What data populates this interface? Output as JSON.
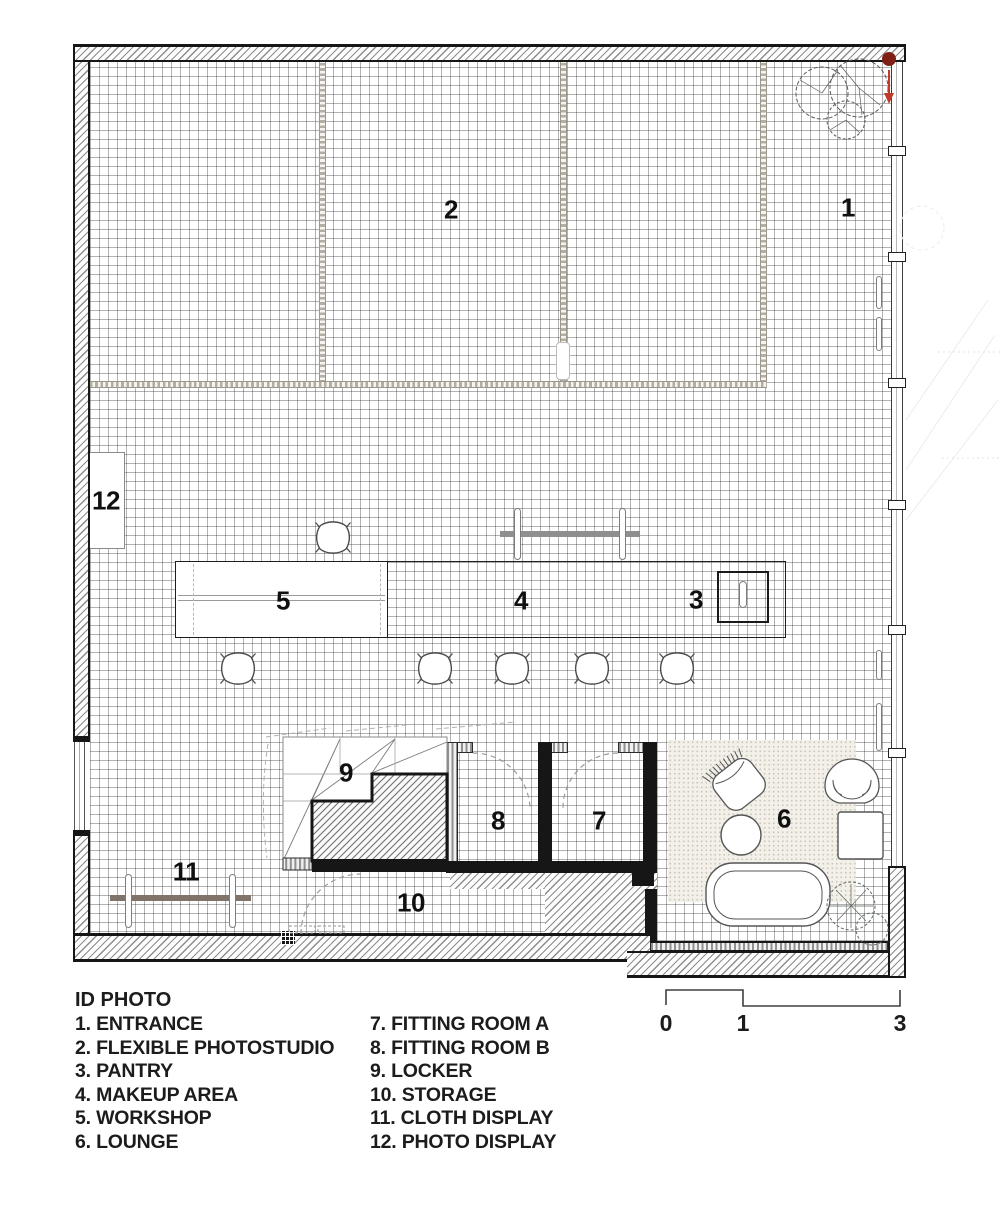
{
  "rooms": {
    "entrance": "1",
    "photostudio": "2",
    "pantry": "3",
    "makeup": "4",
    "workshop": "5",
    "lounge": "6",
    "fitting_a": "7",
    "fitting_b": "8",
    "locker": "9",
    "storage": "10",
    "cloth_display": "11",
    "photo_display": "12"
  },
  "legend": {
    "title": "ID PHOTO",
    "left": [
      "1. ENTRANCE",
      "2. FLEXIBLE PHOTOSTUDIO",
      "3. PANTRY",
      "4. MAKEUP AREA",
      "5. WORKSHOP",
      "6. LOUNGE"
    ],
    "right": [
      "7. FITTING ROOM A",
      "8. FITTING ROOM B",
      "9. LOCKER",
      "10. STORAGE",
      "11. CLOTH DISPLAY",
      "12. PHOTO DISPLAY"
    ]
  },
  "scale_bar": {
    "labels": [
      "0",
      "1",
      "3"
    ]
  },
  "colors": {
    "wall": "#161616",
    "grid_line": "#5a5a5a",
    "entry_marker_red": "#7e2015",
    "arrow_red": "#c0392b",
    "rail_gray": "#8f8f8f",
    "rail_brown": "#80736a",
    "curtain_track": "#b3aea4",
    "rug": "#f2f0e9"
  }
}
